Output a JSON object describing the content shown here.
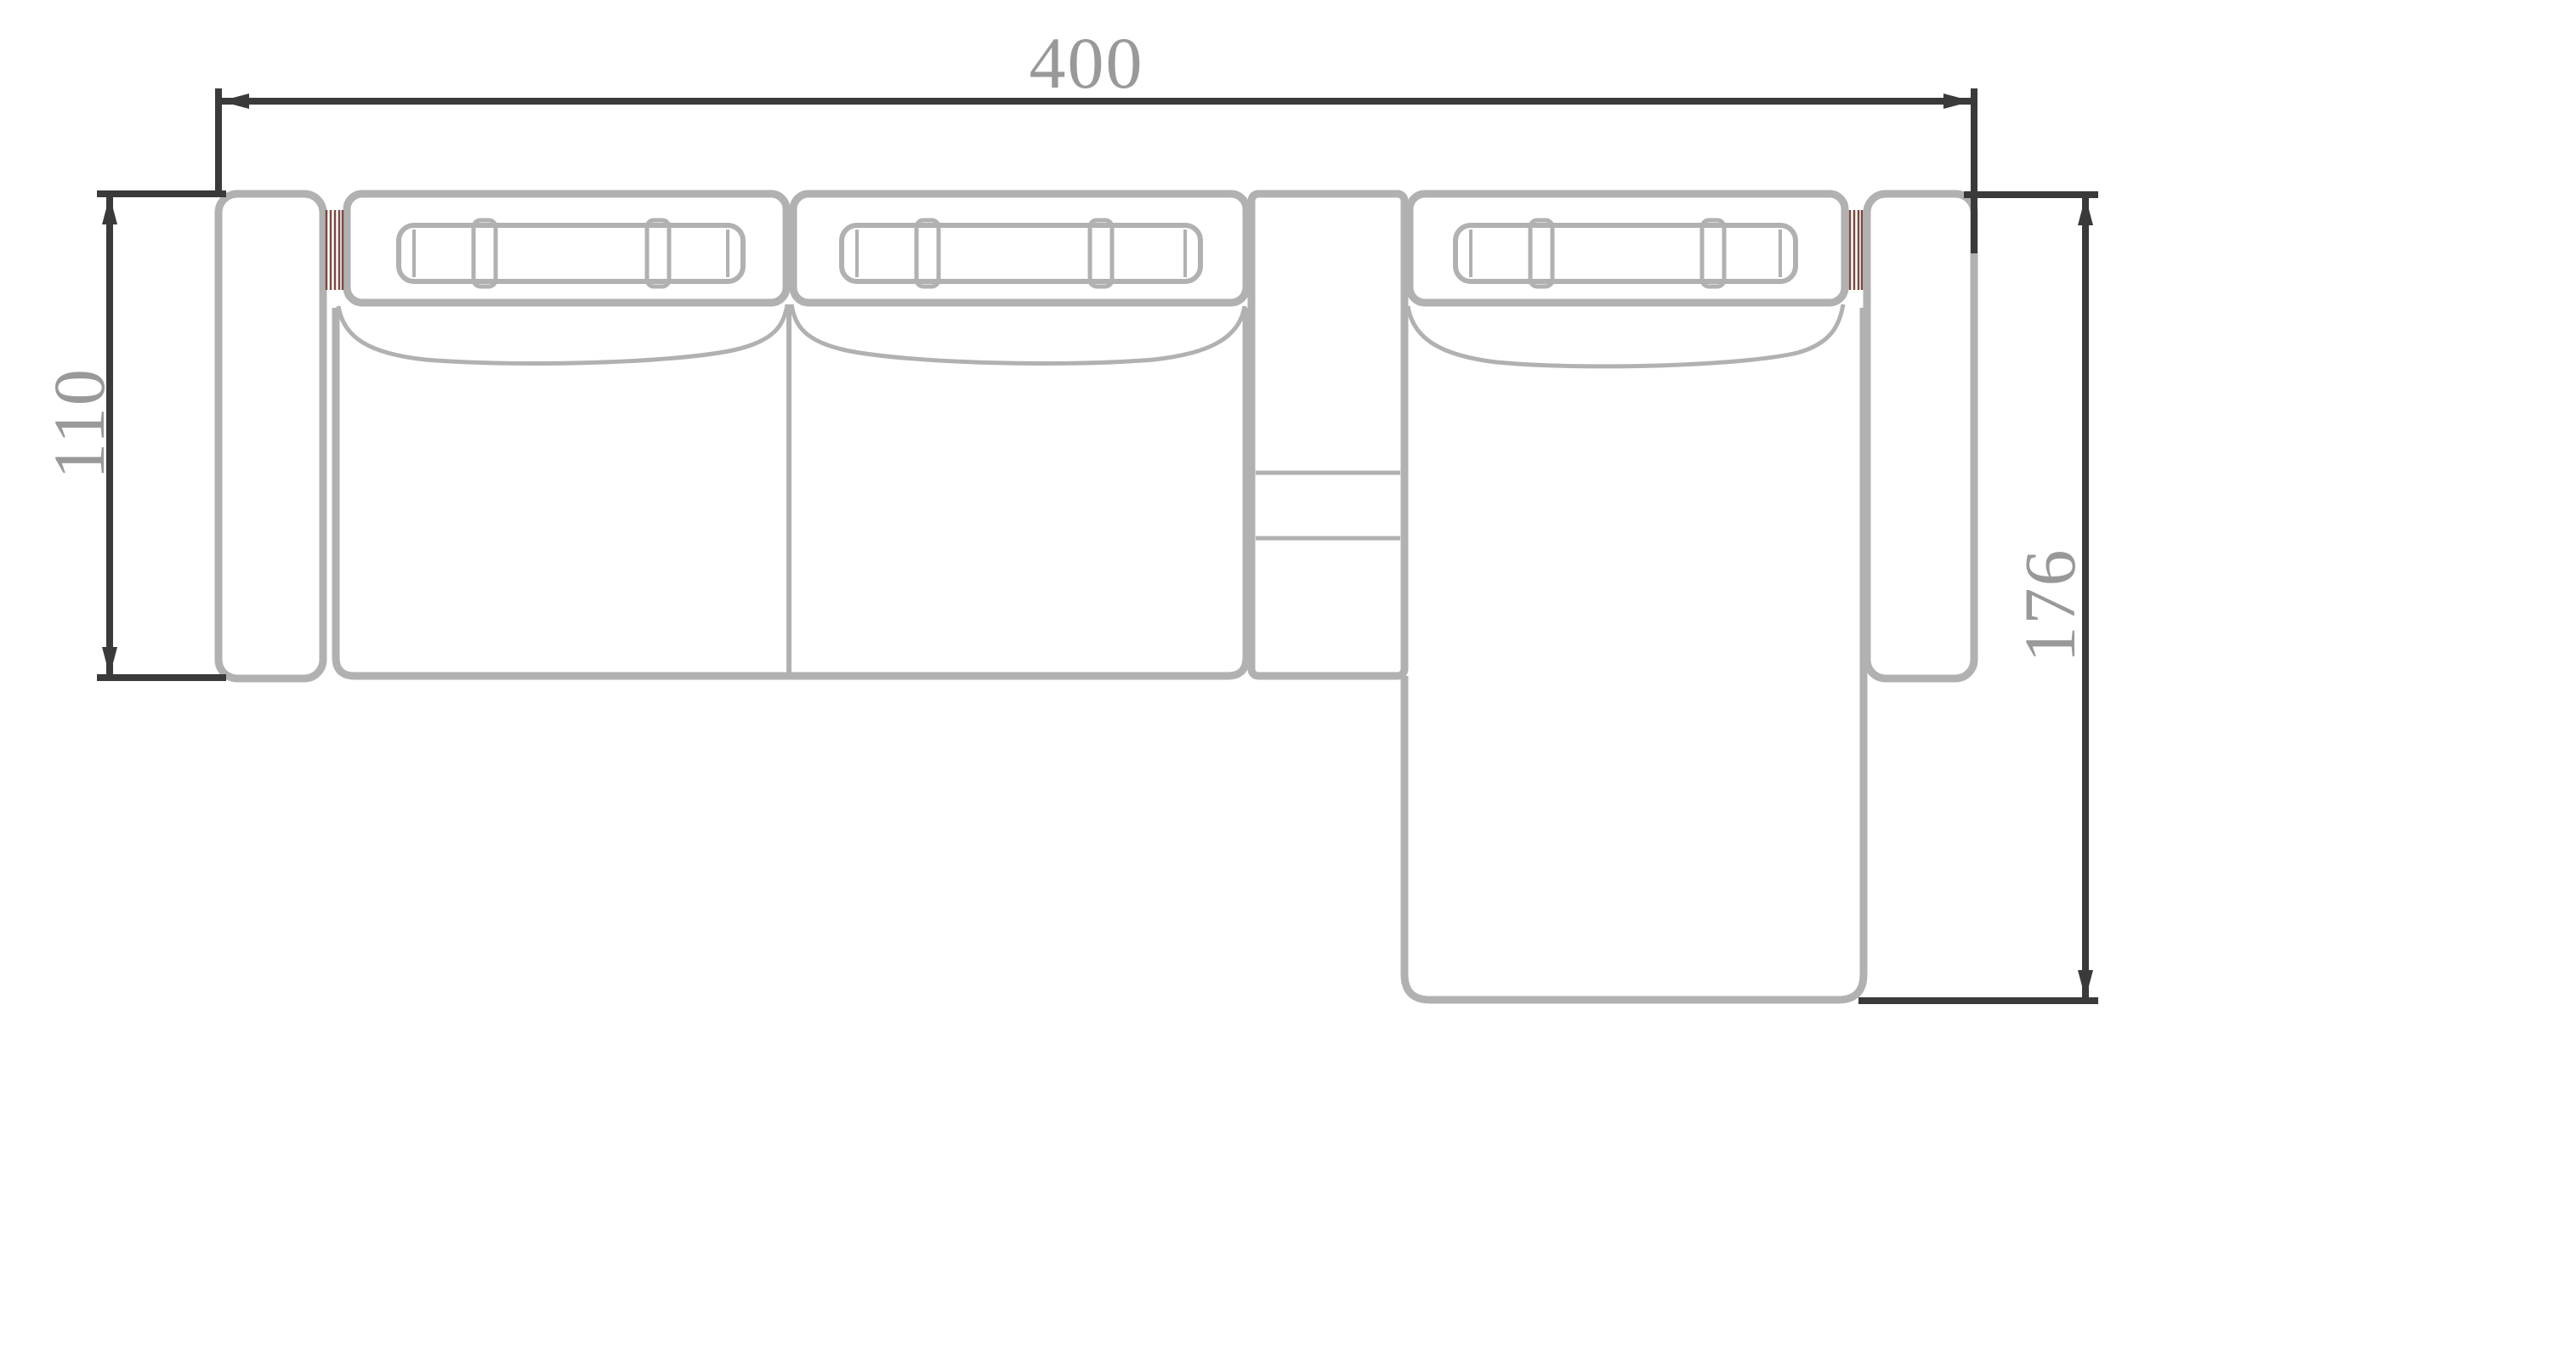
{
  "drawing": {
    "title": "Sectional sofa with chaise — top view technical drawing",
    "dimensions": {
      "overall_width": "400",
      "sofa_depth": "110",
      "chaise_depth": "176"
    },
    "parts": [
      "left-armrest",
      "seat-1-backrest-with-headrest",
      "seat-2-backrest-with-headrest",
      "seat-1-cushion",
      "seat-2-cushion",
      "center-console",
      "chaise-backrest-with-headrest",
      "chaise-lounge-cushion",
      "right-armrest"
    ],
    "colors": {
      "background": "#ffffff",
      "dimension_line": "#3a3a3a",
      "dimension_text": "#999999",
      "furniture_outline": "#b1b1b1",
      "joint_hatch_accent": "#7b4a43"
    }
  }
}
